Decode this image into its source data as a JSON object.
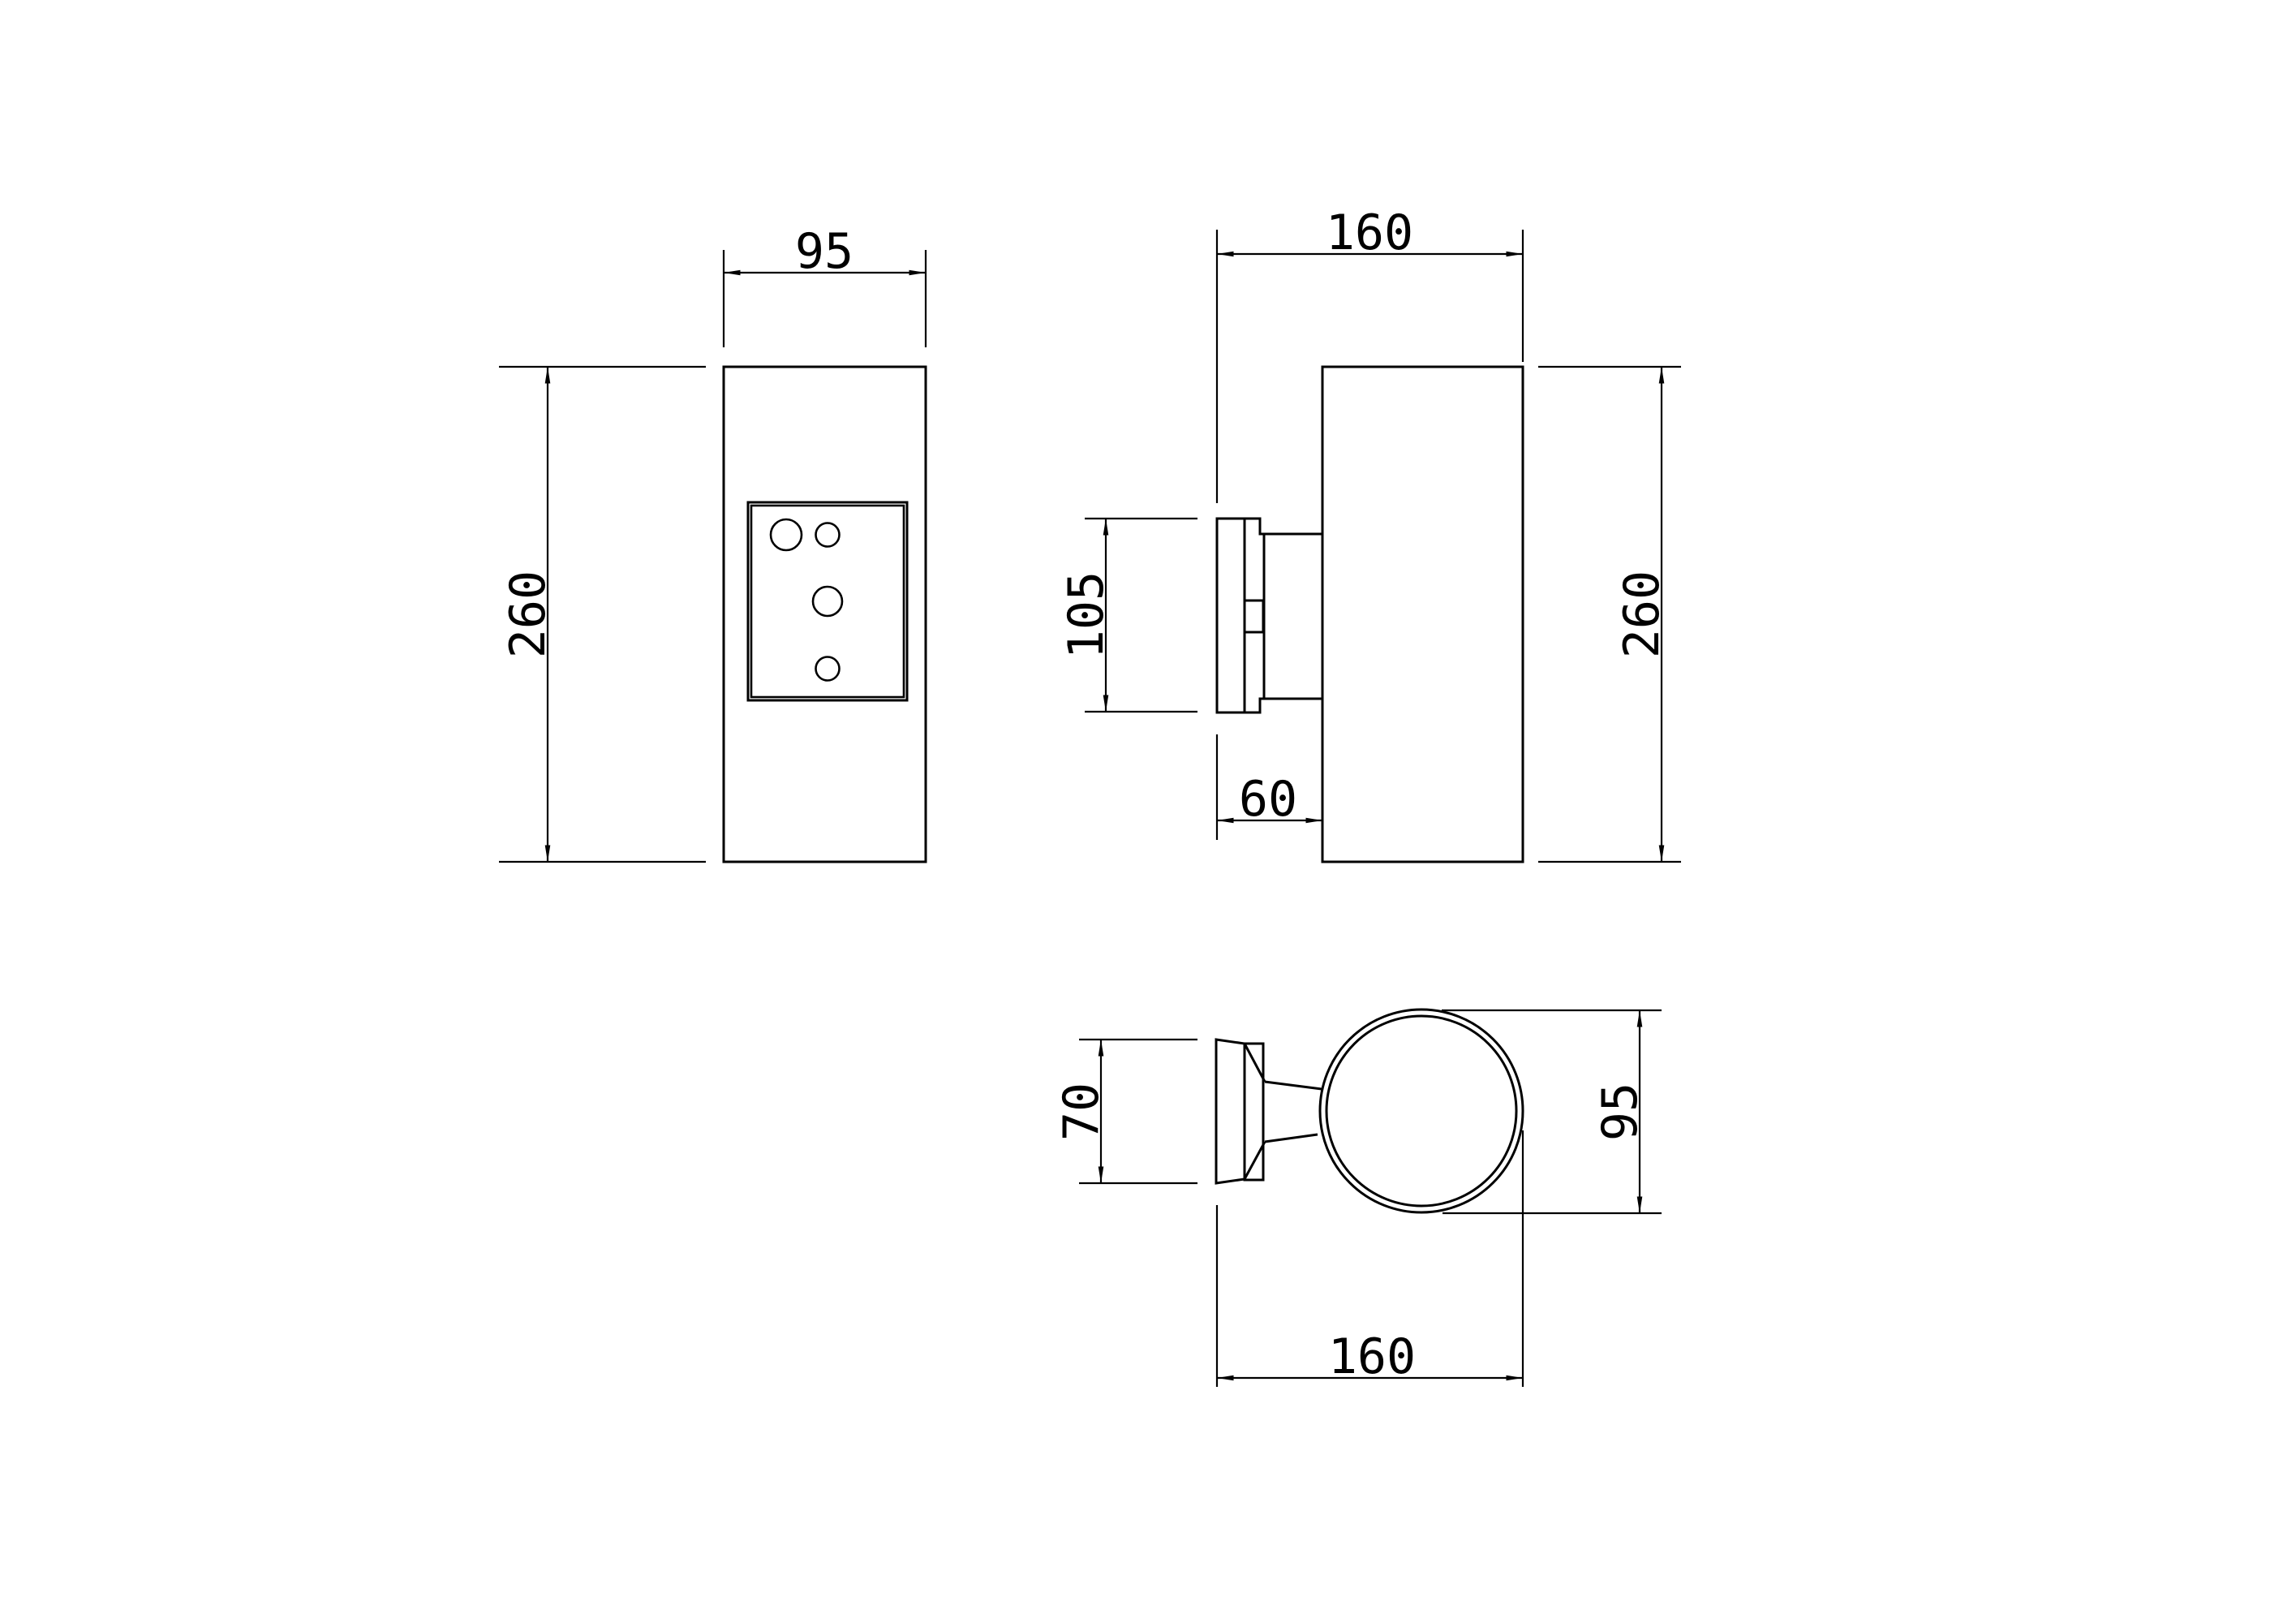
{
  "drawing": {
    "background_color": "#ffffff",
    "line_color": "#000000",
    "views": {
      "front": {
        "width_mm": "95",
        "height_mm": "260"
      },
      "side": {
        "depth_mm": "160",
        "height_mm": "260",
        "plate_height_mm": "105",
        "plate_depth_mm": "60"
      },
      "top": {
        "plate_width_mm": "70",
        "body_diameter_mm": "95",
        "depth_mm": "160"
      }
    }
  }
}
